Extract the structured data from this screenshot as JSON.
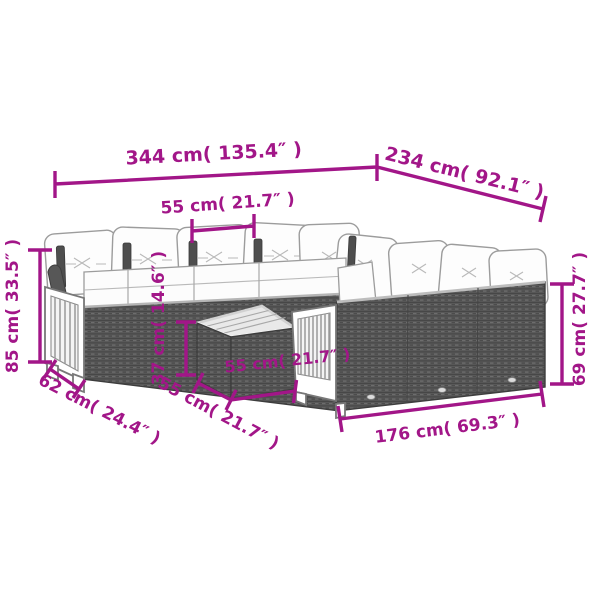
{
  "diagram": {
    "subject": "rattan corner sofa set with cushions, wooden slat armrests and square tea table (grayscale line art with magenta dimension callouts)",
    "accent_color": "#A21688",
    "dimensions": {
      "total_width": {
        "label": "344 cm( 135.4″ )",
        "cm": 344,
        "inches": 135.4
      },
      "total_depth": {
        "label": "234 cm( 92.1″ )",
        "cm": 234,
        "inches": 92.1
      },
      "seat_width": {
        "label": "55 cm( 21.7″ )",
        "cm": 55,
        "inches": 21.7
      },
      "total_height": {
        "label": "85 cm( 33.5″ )",
        "cm": 85,
        "inches": 33.5
      },
      "seat_height": {
        "label": "37 cm( 14.6″ )",
        "cm": 37,
        "inches": 14.6
      },
      "arm_depth": {
        "label": "62 cm( 24.4″ )",
        "cm": 62,
        "inches": 24.4
      },
      "table_width": {
        "label": "55 cm( 21.7″ )",
        "cm": 55,
        "inches": 21.7
      },
      "table_depth": {
        "label": "55 cm( 21.7″ )",
        "cm": 55,
        "inches": 21.7
      },
      "section_length": {
        "label": "176 cm( 69.3″ )",
        "cm": 176,
        "inches": 69.3
      },
      "back_height": {
        "label": "69 cm( 27.7″ )",
        "cm": 69,
        "inches": 27.7
      }
    }
  }
}
